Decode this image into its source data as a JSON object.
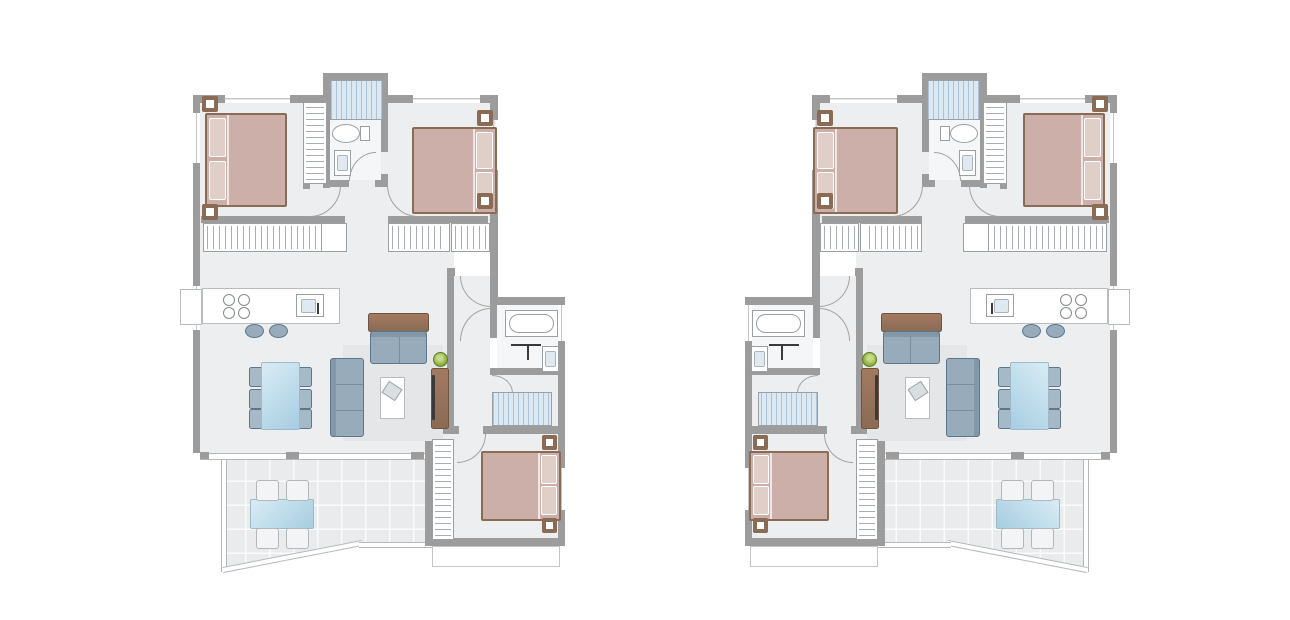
{
  "scene": {
    "type": "floor-plan-pair",
    "background": "#ffffff",
    "plans": [
      {
        "id": "unit-a",
        "mirrored": false
      },
      {
        "id": "unit-b",
        "mirrored": true
      }
    ]
  },
  "palette": {
    "wall": "#9c9c9c",
    "floor": "#edeef0",
    "bath_floor": "#f4f6f7",
    "rug": "#e4e6e7",
    "bed": "#ccafa8",
    "bed_light": "#e0cfc9",
    "wood": "#8a6b55",
    "wood_light": "#a37a60",
    "sofa": "#97abbb",
    "sofa_dark": "#5d7688",
    "chair": "#a6b9c7",
    "glass_1": "#d9ecf5",
    "glass_2": "#a6cde1",
    "stair": "#dde9f2",
    "stair_line": "#abc2d6",
    "tile": "#e9ebec",
    "tile_line": "#fafbfb",
    "plant": "#93b23d",
    "plant_dark": "#6d8f2c",
    "fixture": "#9aa0a3",
    "dark": "#3a3a3a"
  },
  "legend": {
    "rooms": [
      "bedroom-1",
      "bedroom-2",
      "bedroom-3",
      "bathroom-1",
      "bathroom-2",
      "hall",
      "kitchen",
      "living-dining",
      "staircase",
      "terrace",
      "balcony"
    ],
    "furniture": [
      "double-bed",
      "nightstand",
      "wardrobe",
      "closet",
      "toilet",
      "washbasin",
      "bathtub",
      "shower",
      "staircase",
      "kitchen-counter",
      "hob",
      "kitchen-sink",
      "bar-stool",
      "dining-table",
      "dining-chair",
      "sofa",
      "loveseat",
      "console",
      "coffee-table",
      "tv-unit",
      "plant",
      "terrace-table",
      "terrace-chair"
    ]
  }
}
